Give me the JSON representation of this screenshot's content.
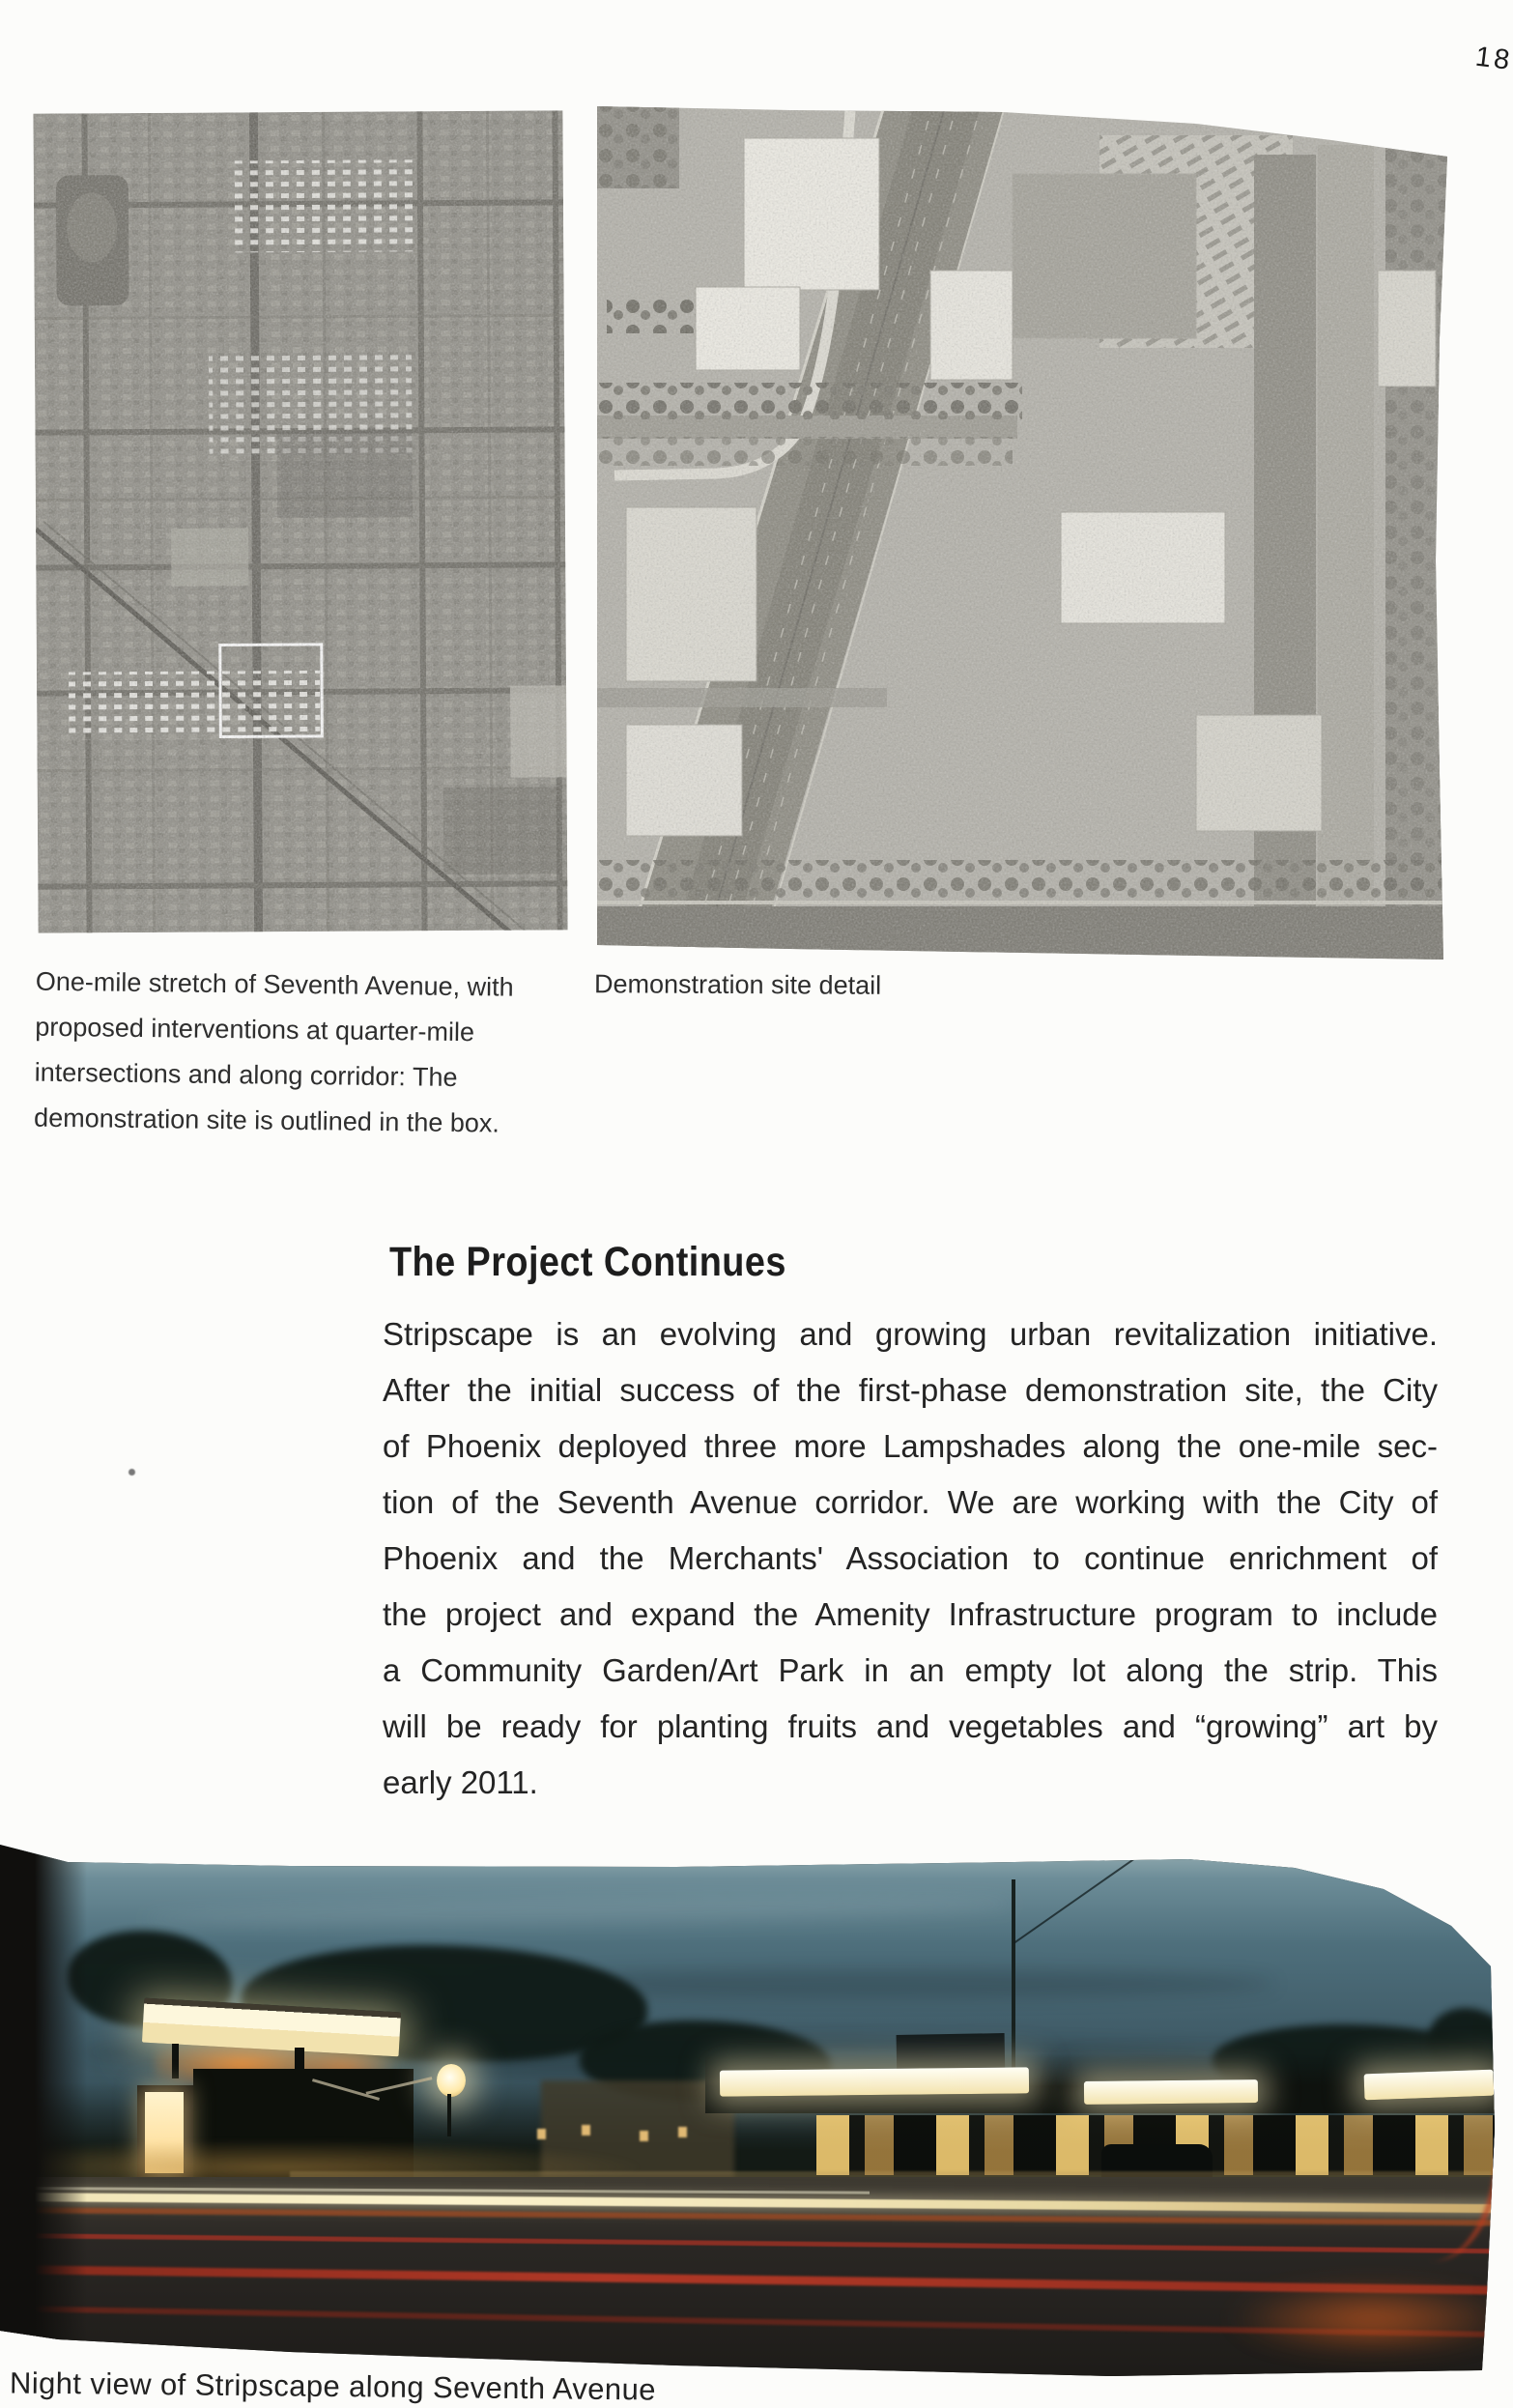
{
  "page": {
    "number": "186"
  },
  "figures": {
    "left_aerial": {
      "name": "aerial-overview-of-seventh-avenue",
      "caption_lines": [
        "One-mile stretch of Seventh Avenue, with",
        "proposed interventions at quarter-mile",
        "intersections and along corridor: The",
        "demonstration site is outlined in the box."
      ]
    },
    "right_aerial": {
      "name": "demonstration-site-aerial-detail",
      "caption": "Demonstration site detail"
    },
    "night_photo": {
      "name": "night-view-photograph",
      "caption": "Night view of Stripscape along Seventh Avenue"
    }
  },
  "article": {
    "heading": "The Project Continues",
    "body_lines": [
      "Stripscape is an evolving and growing urban revitalization initiative.",
      "After the initial success of the first-phase demonstration site, the City",
      "of Phoenix deployed three more Lampshades along the one-mile sec-",
      "tion of the Seventh Avenue corridor. We are working with the City of",
      "Phoenix and the Merchants' Association to continue enrichment of",
      "the project and expand the Amenity Infrastructure program to include",
      "a Community Garden/Art Park in an empty lot along the strip. This",
      "will be ready for planting fruits and vegetables and “growing” art by",
      "early 2011."
    ]
  },
  "colors": {
    "page_bg": "#fcfcfa",
    "ink": "#242424",
    "aerial_left_base": "#8e8c84",
    "aerial_right_base": "#b3b1a9",
    "sky_top": "#a3b8ba",
    "sky_bottom": "#2c4049",
    "lamp_glow": "#fdf7dc",
    "ember_orange": "#e0741c",
    "taillight_red": "#a33124",
    "trail_yellow": "#fcf3cd"
  }
}
